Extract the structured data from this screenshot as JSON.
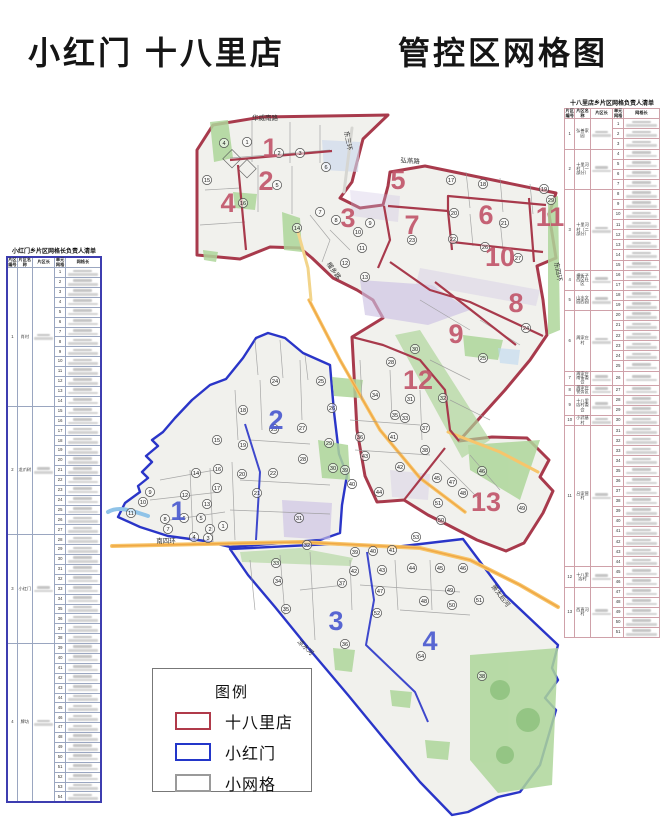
{
  "title": {
    "left": "小红门 十八里店",
    "right": "管控区网格图"
  },
  "legend": {
    "title": "图例",
    "items": [
      {
        "label": "十八里店",
        "color": "#b03a4a"
      },
      {
        "label": "小红门",
        "color": "#2336c9"
      },
      {
        "label": "小网格",
        "color": "#9a9a9a"
      }
    ]
  },
  "left_table": {
    "title": "小红门乡片区网格长负责人清单",
    "headers": [
      "片区编号",
      "片区名称",
      "片区长",
      "单元网格",
      "网格长"
    ],
    "groups": [
      {
        "no": "1",
        "name": "肖村",
        "unit_from": 1,
        "unit_to": 14
      },
      {
        "no": "2",
        "name": "龙爪树",
        "unit_from": 15,
        "unit_to": 27
      },
      {
        "no": "3",
        "name": "小红门",
        "unit_from": 28,
        "unit_to": 38
      },
      {
        "no": "4",
        "name": "牌坊",
        "unit_from": 39,
        "unit_to": 54
      }
    ]
  },
  "right_table": {
    "title": "十八里店乡片区网格负责人清单",
    "headers": [
      "片区编号",
      "片区名称",
      "片区长",
      "单元网格",
      "网格长"
    ],
    "groups": [
      {
        "no": "1",
        "name": "弘善家园",
        "unit_from": 1,
        "unit_to": 3
      },
      {
        "no": "2",
        "name": "十里河村（一部分）",
        "unit_from": 4,
        "unit_to": 7
      },
      {
        "no": "3",
        "name": "十里河村（二部分）",
        "unit_from": 8,
        "unit_to": 15
      },
      {
        "no": "4",
        "name": "横街子西区社区",
        "unit_from": 16,
        "unit_to": 17
      },
      {
        "no": "5",
        "name": "山水文园西园",
        "unit_from": 18,
        "unit_to": 19
      },
      {
        "no": "6",
        "name": "周家庄村",
        "unit_from": 20,
        "unit_to": 25
      },
      {
        "no": "7",
        "name": "周家庄南街委会",
        "unit_from": 26,
        "unit_to": 26
      },
      {
        "no": "8",
        "name": "周家庄警务区",
        "unit_from": 27,
        "unit_to": 27
      },
      {
        "no": "9",
        "name": "十八里店村委会",
        "unit_from": 28,
        "unit_to": 29
      },
      {
        "no": "10",
        "name": "小武基村",
        "unit_from": 30,
        "unit_to": 30
      },
      {
        "no": "11",
        "name": "吕家营村",
        "unit_from": 31,
        "unit_to": 44
      },
      {
        "no": "12",
        "name": "十八里店村",
        "unit_from": 45,
        "unit_to": 46
      },
      {
        "no": "13",
        "name": "西直河村",
        "unit_from": 47,
        "unit_to": 51
      }
    ]
  },
  "map": {
    "colors": {
      "shibalidian_boundary": "#a83a4c",
      "xiaohongmen_boundary": "#2a35c8",
      "small_grid": "#9a9a9a"
    },
    "red_zone_numbers": [
      {
        "n": "1",
        "x": 270,
        "y": 148
      },
      {
        "n": "2",
        "x": 266,
        "y": 181
      },
      {
        "n": "3",
        "x": 348,
        "y": 218
      },
      {
        "n": "4",
        "x": 228,
        "y": 203
      },
      {
        "n": "5",
        "x": 398,
        "y": 180
      },
      {
        "n": "6",
        "x": 486,
        "y": 215
      },
      {
        "n": "7",
        "x": 412,
        "y": 225
      },
      {
        "n": "8",
        "x": 516,
        "y": 303
      },
      {
        "n": "9",
        "x": 456,
        "y": 334
      },
      {
        "n": "10",
        "x": 500,
        "y": 257
      },
      {
        "n": "11",
        "x": 550,
        "y": 217
      },
      {
        "n": "12",
        "x": 418,
        "y": 380
      },
      {
        "n": "13",
        "x": 486,
        "y": 502
      }
    ],
    "blue_zone_numbers": [
      {
        "n": "1",
        "x": 178,
        "y": 511
      },
      {
        "n": "2",
        "x": 276,
        "y": 420
      },
      {
        "n": "3",
        "x": 336,
        "y": 621
      },
      {
        "n": "4",
        "x": 430,
        "y": 641
      }
    ],
    "red_circles": [
      {
        "n": "1",
        "x": 247,
        "y": 142
      },
      {
        "n": "2",
        "x": 279,
        "y": 153
      },
      {
        "n": "3",
        "x": 300,
        "y": 153
      },
      {
        "n": "4",
        "x": 224,
        "y": 143
      },
      {
        "n": "5",
        "x": 277,
        "y": 185
      },
      {
        "n": "6",
        "x": 326,
        "y": 167
      },
      {
        "n": "7",
        "x": 320,
        "y": 212
      },
      {
        "n": "8",
        "x": 336,
        "y": 220
      },
      {
        "n": "9",
        "x": 370,
        "y": 223
      },
      {
        "n": "10",
        "x": 358,
        "y": 232
      },
      {
        "n": "11",
        "x": 362,
        "y": 248
      },
      {
        "n": "12",
        "x": 345,
        "y": 263
      },
      {
        "n": "13",
        "x": 365,
        "y": 277
      },
      {
        "n": "14",
        "x": 297,
        "y": 228
      },
      {
        "n": "15",
        "x": 207,
        "y": 180
      },
      {
        "n": "16",
        "x": 243,
        "y": 203
      },
      {
        "n": "17",
        "x": 451,
        "y": 180
      },
      {
        "n": "18",
        "x": 483,
        "y": 184
      },
      {
        "n": "19",
        "x": 544,
        "y": 189
      },
      {
        "n": "20",
        "x": 454,
        "y": 213
      },
      {
        "n": "21",
        "x": 504,
        "y": 223
      },
      {
        "n": "22",
        "x": 453,
        "y": 239
      },
      {
        "n": "23",
        "x": 412,
        "y": 240
      },
      {
        "n": "24",
        "x": 526,
        "y": 328
      },
      {
        "n": "25",
        "x": 483,
        "y": 358
      },
      {
        "n": "26",
        "x": 485,
        "y": 247
      },
      {
        "n": "27",
        "x": 518,
        "y": 258
      },
      {
        "n": "28",
        "x": 391,
        "y": 362
      },
      {
        "n": "29",
        "x": 551,
        "y": 200
      },
      {
        "n": "30",
        "x": 415,
        "y": 349
      },
      {
        "n": "31",
        "x": 410,
        "y": 399
      },
      {
        "n": "32",
        "x": 443,
        "y": 398
      },
      {
        "n": "33",
        "x": 405,
        "y": 418
      },
      {
        "n": "34",
        "x": 375,
        "y": 395
      },
      {
        "n": "35",
        "x": 395,
        "y": 415
      },
      {
        "n": "36",
        "x": 360,
        "y": 437
      },
      {
        "n": "37",
        "x": 425,
        "y": 428
      },
      {
        "n": "38",
        "x": 425,
        "y": 450
      },
      {
        "n": "39",
        "x": 345,
        "y": 470
      },
      {
        "n": "40",
        "x": 352,
        "y": 484
      },
      {
        "n": "41",
        "x": 393,
        "y": 437
      },
      {
        "n": "42",
        "x": 400,
        "y": 467
      },
      {
        "n": "43",
        "x": 365,
        "y": 456
      },
      {
        "n": "44",
        "x": 379,
        "y": 492
      },
      {
        "n": "45",
        "x": 437,
        "y": 478
      },
      {
        "n": "46",
        "x": 482,
        "y": 471
      },
      {
        "n": "47",
        "x": 452,
        "y": 482
      },
      {
        "n": "48",
        "x": 463,
        "y": 493
      },
      {
        "n": "49",
        "x": 522,
        "y": 508
      },
      {
        "n": "50",
        "x": 441,
        "y": 520
      },
      {
        "n": "51",
        "x": 438,
        "y": 503
      }
    ],
    "blue_circles": [
      {
        "n": "1",
        "x": 223,
        "y": 526
      },
      {
        "n": "2",
        "x": 210,
        "y": 529
      },
      {
        "n": "3",
        "x": 208,
        "y": 538
      },
      {
        "n": "4",
        "x": 194,
        "y": 537
      },
      {
        "n": "5",
        "x": 201,
        "y": 518
      },
      {
        "n": "6",
        "x": 184,
        "y": 518
      },
      {
        "n": "7",
        "x": 168,
        "y": 529
      },
      {
        "n": "8",
        "x": 165,
        "y": 519
      },
      {
        "n": "9",
        "x": 150,
        "y": 492
      },
      {
        "n": "10",
        "x": 143,
        "y": 502
      },
      {
        "n": "11",
        "x": 131,
        "y": 513
      },
      {
        "n": "12",
        "x": 185,
        "y": 495
      },
      {
        "n": "13",
        "x": 207,
        "y": 504
      },
      {
        "n": "14",
        "x": 196,
        "y": 473
      },
      {
        "n": "15",
        "x": 217,
        "y": 440
      },
      {
        "n": "16",
        "x": 218,
        "y": 469
      },
      {
        "n": "17",
        "x": 217,
        "y": 488
      },
      {
        "n": "18",
        "x": 243,
        "y": 410
      },
      {
        "n": "19",
        "x": 243,
        "y": 445
      },
      {
        "n": "20",
        "x": 242,
        "y": 474
      },
      {
        "n": "21",
        "x": 257,
        "y": 493
      },
      {
        "n": "22",
        "x": 273,
        "y": 473
      },
      {
        "n": "23",
        "x": 274,
        "y": 429
      },
      {
        "n": "24",
        "x": 275,
        "y": 381
      },
      {
        "n": "25",
        "x": 321,
        "y": 381
      },
      {
        "n": "26",
        "x": 332,
        "y": 408
      },
      {
        "n": "27",
        "x": 302,
        "y": 428
      },
      {
        "n": "28",
        "x": 303,
        "y": 459
      },
      {
        "n": "29",
        "x": 329,
        "y": 443
      },
      {
        "n": "30",
        "x": 333,
        "y": 468
      },
      {
        "n": "31",
        "x": 299,
        "y": 518
      },
      {
        "n": "32",
        "x": 307,
        "y": 545
      },
      {
        "n": "33",
        "x": 276,
        "y": 563
      },
      {
        "n": "34",
        "x": 278,
        "y": 581
      },
      {
        "n": "35",
        "x": 286,
        "y": 609
      },
      {
        "n": "36",
        "x": 345,
        "y": 644
      },
      {
        "n": "37",
        "x": 342,
        "y": 583
      },
      {
        "n": "38",
        "x": 482,
        "y": 676
      },
      {
        "n": "39",
        "x": 355,
        "y": 552
      },
      {
        "n": "40",
        "x": 373,
        "y": 551
      },
      {
        "n": "41",
        "x": 392,
        "y": 550
      },
      {
        "n": "42",
        "x": 354,
        "y": 571
      },
      {
        "n": "43",
        "x": 382,
        "y": 570
      },
      {
        "n": "44",
        "x": 412,
        "y": 568
      },
      {
        "n": "45",
        "x": 440,
        "y": 568
      },
      {
        "n": "46",
        "x": 463,
        "y": 568
      },
      {
        "n": "47",
        "x": 380,
        "y": 591
      },
      {
        "n": "48",
        "x": 424,
        "y": 601
      },
      {
        "n": "49",
        "x": 450,
        "y": 590
      },
      {
        "n": "50",
        "x": 452,
        "y": 605
      },
      {
        "n": "51",
        "x": 479,
        "y": 600
      },
      {
        "n": "52",
        "x": 377,
        "y": 613
      },
      {
        "n": "53",
        "x": 416,
        "y": 537
      },
      {
        "n": "54",
        "x": 421,
        "y": 656
      }
    ],
    "road_labels": [
      {
        "text": "华威南路",
        "x": 265,
        "y": 120,
        "rot": 0
      },
      {
        "text": "东三环",
        "x": 346,
        "y": 141,
        "rot": 80
      },
      {
        "text": "弘燕路",
        "x": 410,
        "y": 163,
        "rot": 4
      },
      {
        "text": "榴乡路",
        "x": 332,
        "y": 272,
        "rot": 55
      },
      {
        "text": "南四环",
        "x": 166,
        "y": 543,
        "rot": 0
      },
      {
        "text": "东四环",
        "x": 556,
        "y": 272,
        "rot": 80
      },
      {
        "text": "凉水河",
        "x": 304,
        "y": 649,
        "rot": 43
      },
      {
        "text": "萧太后河",
        "x": 499,
        "y": 597,
        "rot": 52
      }
    ]
  }
}
